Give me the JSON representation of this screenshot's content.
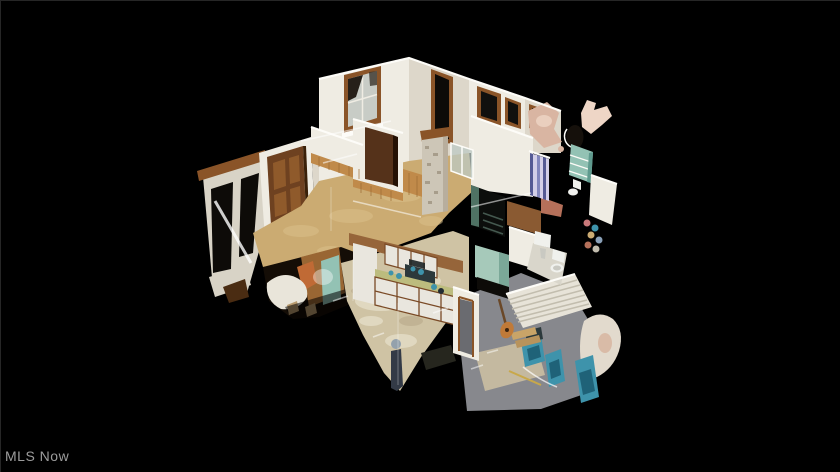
{
  "watermark": {
    "label": "MLS Now"
  },
  "scene": {
    "type": "3d-dollhouse-cutaway-view",
    "subject": "Top-down isometric dollhouse scan of a single-story home interior floating on a black background: living room with window and wood wainscoting, stone chimney, dark wood doors, kitchen with white cabinets and olive countertop, hallway, bathrooms with striped curtain and white fixtures, gray-carpet room with slatted radiator wall and teal equipment, blurred standing person figure, and torn scan fragments at the edges",
    "colors": {
      "black": "#000000",
      "edge": "#262626",
      "watermarkColor": "#9c9c9c",
      "wallWhite": "#efece3",
      "wallShade": "#ddd7ca",
      "wallBright": "#fdfcf8",
      "wallDim": "#d8d3c6",
      "woodTrim": "#8a5428",
      "doorBrown": "#6e4120",
      "doorPanel": "#8f5a2b",
      "doorEdge": "#3a2008",
      "wainscot": "#c08a4a",
      "wainscotDark": "#9c6c34",
      "floorTan": "#cbab72",
      "floorTanLight": "#dcc28c",
      "floorMottled": "#cfc3a4",
      "floorMottleLight": "#e8e1cc",
      "floorDarkPatch": "#b3a383",
      "stone": "#cdc6b7",
      "stoneDark": "#a79d8b",
      "counterOlive": "#bcbc7e",
      "cabinetWhite": "#e9e6de",
      "cabinetFrame": "#7a4a26",
      "applianceDark": "#2c393c",
      "tealObject": "#3e93ab",
      "tealDark": "#1f6278",
      "tealShelf": "#93c2b4",
      "greenStair": "#4f7264",
      "lowerTeal": "#a6c9ba",
      "carpetGray": "#87888d",
      "carpetInset": "#cbbfa2",
      "slatWall": "#e7e3d8",
      "slatLine": "#c2bdae",
      "curtainBlue": "#8387bd",
      "curtainLight": "#d3cfe8",
      "curtainDark": "#555a94",
      "pinkFrag": "#d9b5a2",
      "pinkFragLight": "#eed6c6",
      "salmonCarpet": "#b5705a",
      "fixtureWhite": "#f0f1ed",
      "fixtureShade": "#c9c9c2",
      "tileFloor": "#d9d6cb",
      "darkOpening": "#0d0b08",
      "roomDark": "#140d06",
      "stairDark": "#0c0e0c",
      "personBody": "#333a46",
      "personHead": "#94a1ac",
      "orangeChair": "#c06a35",
      "woodPanel": "#996633",
      "matDark": "#26261e",
      "guitarOrange": "#c07a38",
      "guitarNeck": "#6a4828",
      "white": "#ffffff",
      "hallFloor": "#8a5a32",
      "planksTan": "#c9a468",
      "planksTan2": "#b8935c",
      "drapeWhite": "#e9e5da",
      "debrisTan": "#b89a6e",
      "mirrorDark": "#15100b",
      "glassPane": "#bcc9c4",
      "kitchenWood": "#96653a",
      "doorwayGray": "#6a6b70",
      "yellowStick": "#c8a84a"
    }
  }
}
